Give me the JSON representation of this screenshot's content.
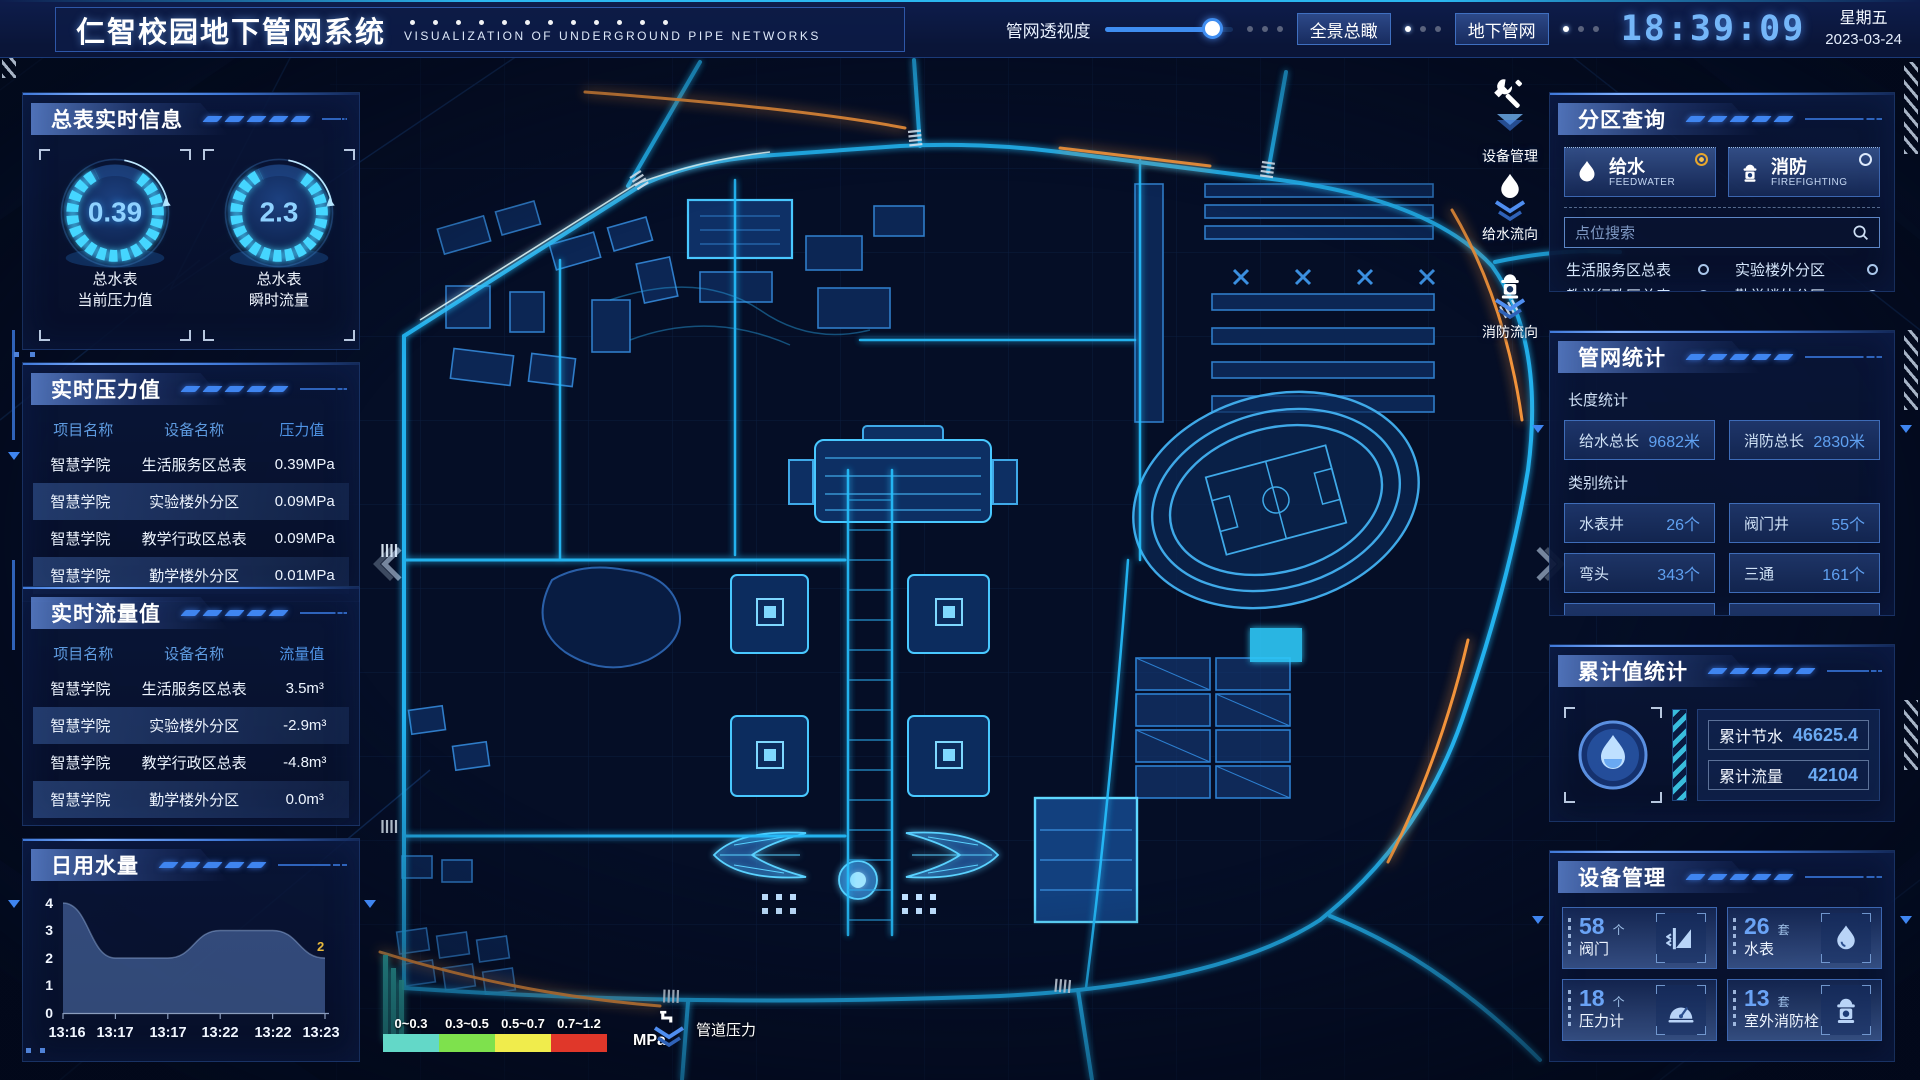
{
  "header": {
    "title": "仁智校园地下管网系统",
    "subtitle": "VISUALIZATION OF UNDERGROUND PIPE NETWORKS",
    "opacity_label": "管网透视度",
    "btn_overview": "全景总瞰",
    "btn_underground": "地下管网",
    "time": "18:39:09",
    "weekday": "星期五",
    "date": "2023-03-24"
  },
  "left": {
    "meter": {
      "title": "总表实时信息",
      "gauges": [
        {
          "value": "0.39",
          "label1": "总水表",
          "label2": "当前压力值"
        },
        {
          "value": "2.3",
          "label1": "总水表",
          "label2": "瞬时流量"
        }
      ]
    },
    "pressure": {
      "title": "实时压力值",
      "columns": [
        "项目名称",
        "设备名称",
        "压力值"
      ],
      "rows": [
        [
          "智慧学院",
          "生活服务区总表",
          "0.39MPa"
        ],
        [
          "智慧学院",
          "实验楼外分区",
          "0.09MPa"
        ],
        [
          "智慧学院",
          "教学行政区总表",
          "0.09MPa"
        ],
        [
          "智慧学院",
          "勤学楼外分区",
          "0.01MPa"
        ],
        [
          "智慧学院",
          "砺学楼外分区",
          "0.00MPa"
        ]
      ]
    },
    "flow": {
      "title": "实时流量值",
      "columns": [
        "项目名称",
        "设备名称",
        "流量值"
      ],
      "rows": [
        [
          "智慧学院",
          "生活服务区总表",
          "3.5m³"
        ],
        [
          "智慧学院",
          "实验楼外分区",
          "-2.9m³"
        ],
        [
          "智慧学院",
          "教学行政区总表",
          "-4.8m³"
        ],
        [
          "智慧学院",
          "勤学楼外分区",
          "0.0m³"
        ],
        [
          "智慧学院",
          "砺学楼外分区",
          "2.2m³"
        ]
      ]
    },
    "daily": {
      "title": "日用水量"
    }
  },
  "chart_data": {
    "type": "area",
    "title": "日用水量",
    "x": [
      "13:16",
      "13:17",
      "13:17",
      "13:22",
      "13:22",
      "13:23"
    ],
    "values": [
      4,
      2,
      2,
      3,
      3,
      2
    ],
    "yticks": [
      0,
      1,
      2,
      3,
      4
    ],
    "ylim": [
      0,
      4
    ],
    "end_label": "2",
    "area_color": "#5e82c4",
    "end_label_color": "#e8b93c"
  },
  "map": {
    "controls": [
      {
        "icon": "wrench-icon",
        "label": "设备管理"
      },
      {
        "icon": "water-drop-icon",
        "label": "给水流向"
      },
      {
        "icon": "hydrant-icon",
        "label": "消防流向"
      }
    ],
    "legend": {
      "ranges": [
        {
          "label": "0~0.3",
          "color": "#63d8c8"
        },
        {
          "label": "0.3~0.5",
          "color": "#7ee14d"
        },
        {
          "label": "0.5~0.7",
          "color": "#f0ec4c"
        },
        {
          "label": "0.7~1.2",
          "color": "#e0372a"
        }
      ],
      "unit": "MPa",
      "flow_label": "管道压力"
    }
  },
  "right": {
    "zone": {
      "title": "分区查询",
      "tabs": [
        {
          "name": "给水",
          "en": "FEEDWATER",
          "selected": true
        },
        {
          "name": "消防",
          "en": "FIREFIGHTING",
          "selected": false
        }
      ],
      "search_placeholder": "点位搜索",
      "items": [
        "生活服务区总表",
        "实验楼外分区",
        "教学行政区总表",
        "勤学楼外分区",
        "砺学楼外分区",
        "宿舍区泵房"
      ]
    },
    "stats": {
      "title": "管网统计",
      "length_label": "长度统计",
      "length_stats": [
        {
          "name": "给水总长",
          "value": "9682米"
        },
        {
          "name": "消防总长",
          "value": "2830米"
        }
      ],
      "category_label": "类别统计",
      "category_stats": [
        {
          "name": "水表井",
          "value": "26个"
        },
        {
          "name": "阀门井",
          "value": "55个"
        },
        {
          "name": "弯头",
          "value": "343个"
        },
        {
          "name": "三通",
          "value": "161个"
        }
      ]
    },
    "cumulative": {
      "title": "累计值统计",
      "stats": [
        {
          "name": "累计节水",
          "value": "46625.4"
        },
        {
          "name": "累计流量",
          "value": "42104"
        }
      ]
    },
    "devices": {
      "title": "设备管理",
      "items": [
        {
          "count": "58",
          "unit": "个",
          "name": "阀门",
          "icon": "valve-icon"
        },
        {
          "count": "26",
          "unit": "套",
          "name": "水表",
          "icon": "water-meter-icon"
        },
        {
          "count": "18",
          "unit": "个",
          "name": "压力计",
          "icon": "pressure-gauge-icon"
        },
        {
          "count": "13",
          "unit": "套",
          "name": "室外消防栓",
          "icon": "outdoor-hydrant-icon"
        }
      ]
    }
  }
}
